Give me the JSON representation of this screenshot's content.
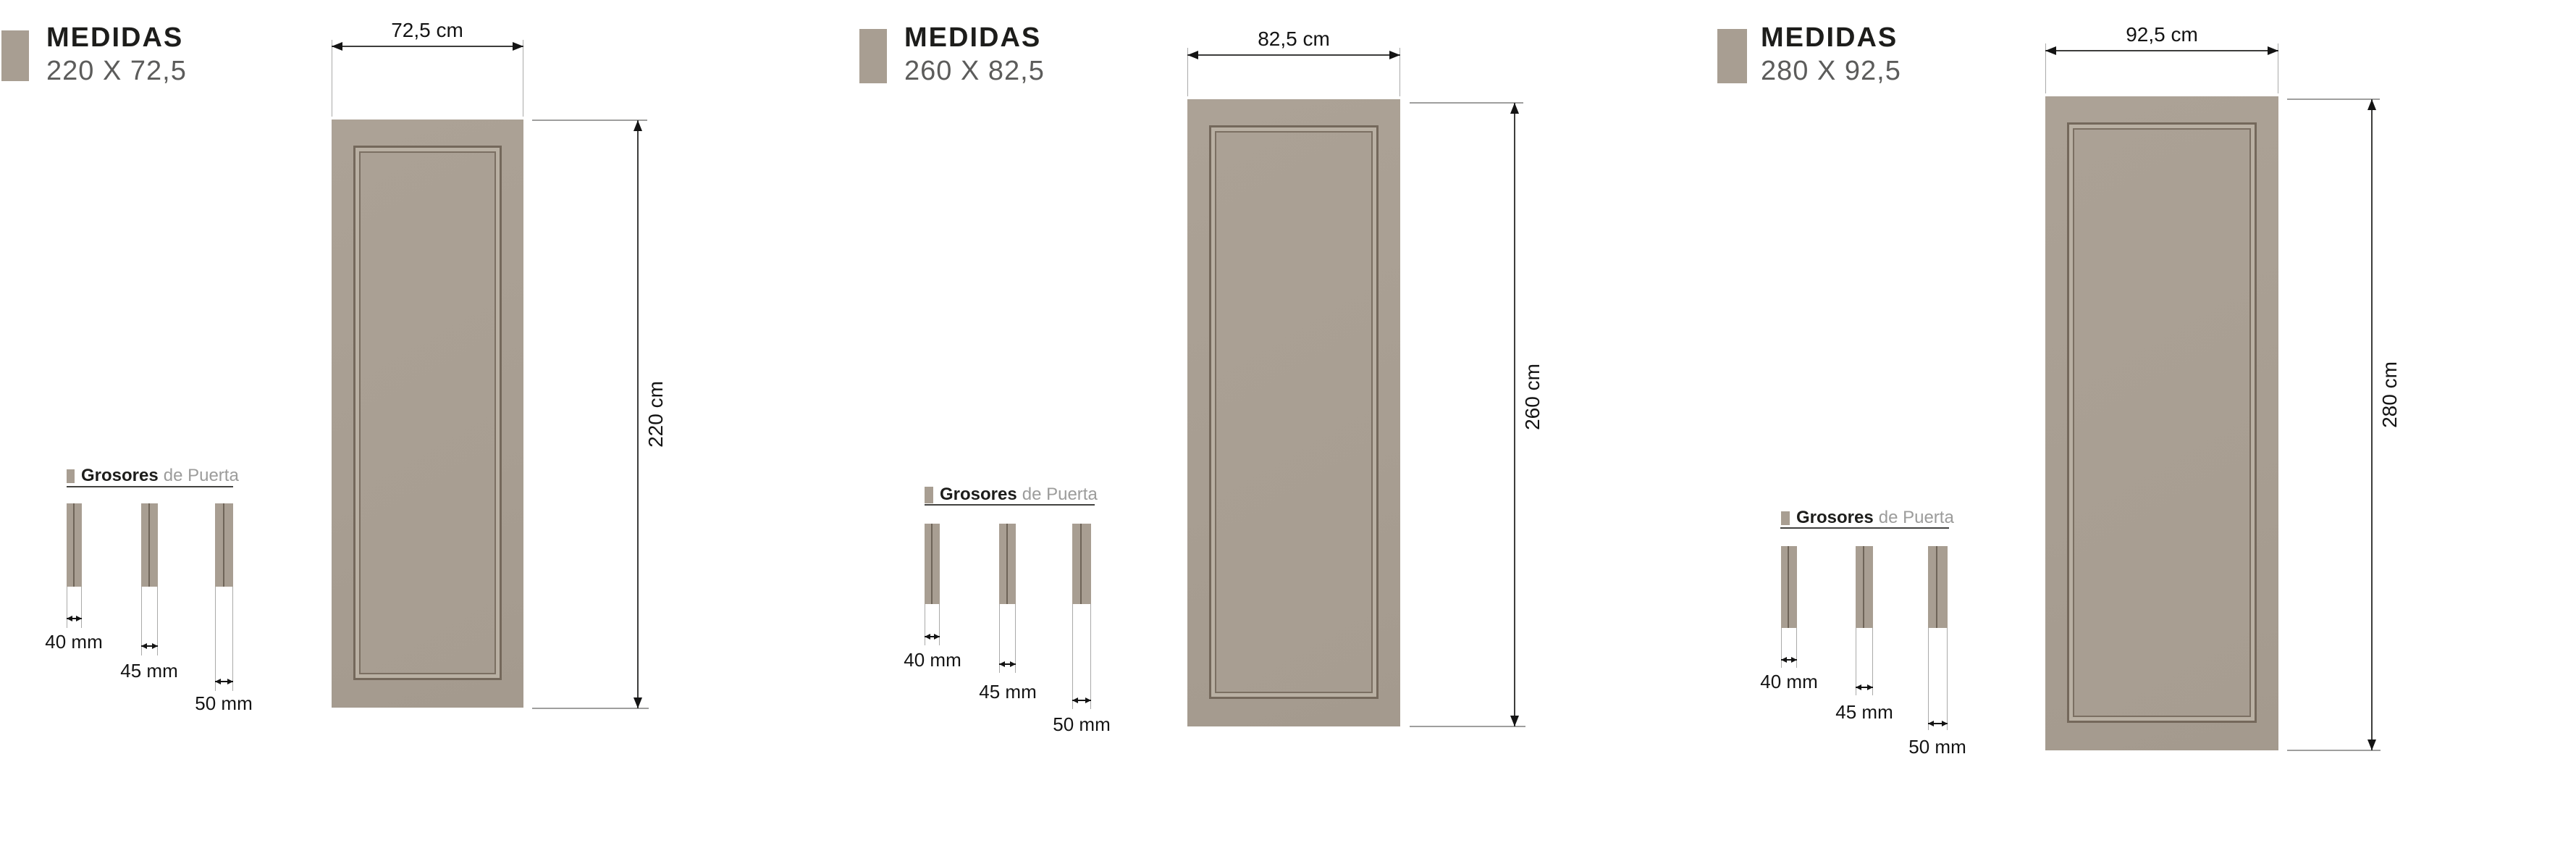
{
  "colors": {
    "door_fill": "#a89e92",
    "moulding_line": "#74685b",
    "heading_text": "#1d1d1b",
    "size_text": "#5c5c5b",
    "muted_text": "#9c9c9b",
    "dimension_line": "#3d3d3c",
    "background": "#ffffff"
  },
  "panels": [
    {
      "title": "MEDIDAS",
      "size": "220 X 72,5",
      "width_label": "72,5 cm",
      "height_label": "220 cm",
      "grosores": {
        "title_bold": "Grosores",
        "title_light": "de Puerta",
        "items": [
          {
            "label": "40 mm"
          },
          {
            "label": "45 mm"
          },
          {
            "label": "50 mm"
          }
        ]
      }
    },
    {
      "title": "MEDIDAS",
      "size": "260 X 82,5",
      "width_label": "82,5 cm",
      "height_label": "260 cm",
      "grosores": {
        "title_bold": "Grosores",
        "title_light": "de Puerta",
        "items": [
          {
            "label": "40 mm"
          },
          {
            "label": "45 mm"
          },
          {
            "label": "50 mm"
          }
        ]
      }
    },
    {
      "title": "MEDIDAS",
      "size": "280 X 92,5",
      "width_label": "92,5 cm",
      "height_label": "280 cm",
      "grosores": {
        "title_bold": "Grosores",
        "title_light": "de Puerta",
        "items": [
          {
            "label": "40 mm"
          },
          {
            "label": "45 mm"
          },
          {
            "label": "50 mm"
          }
        ]
      }
    }
  ]
}
